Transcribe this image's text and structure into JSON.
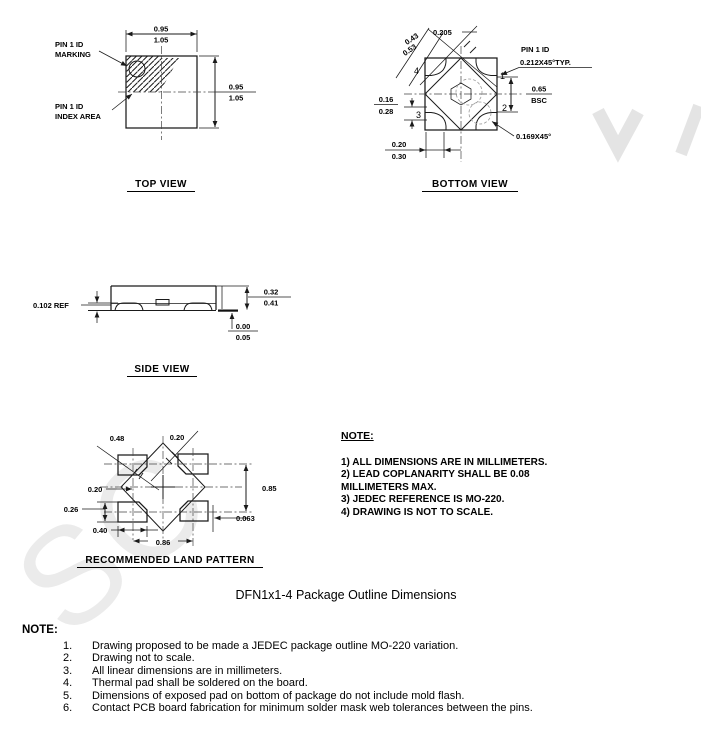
{
  "watermark": {
    "text": "SC"
  },
  "top_view": {
    "title": "TOP VIEW",
    "label_marking_1": "PIN 1 ID",
    "label_marking_2": "MARKING",
    "label_index_1": "PIN 1 ID",
    "label_index_2": "INDEX AREA",
    "dim_width_num": "0.95",
    "dim_width_den": "1.05",
    "dim_height_num": "0.95",
    "dim_height_den": "1.05"
  },
  "bottom_view": {
    "title": "BOTTOM VIEW",
    "dim_diag_num": "0.43",
    "dim_diag_den": "0.53",
    "dim_chamfer_small": "0.205",
    "label_pin1": "PIN 1 ID",
    "dim_pin1_chamfer": "0.212X45°TYP.",
    "dim_pitch_num": "0.65",
    "dim_pitch_den": "BSC",
    "dim_pad_h_num": "0.16",
    "dim_pad_h_den": "0.28",
    "dim_pad_w_num": "0.20",
    "dim_pad_w_den": "0.30",
    "dim_corner": "0.169X45°",
    "pin1": "1",
    "pin2": "2",
    "pin3": "3",
    "pin4": "4"
  },
  "side_view": {
    "title": "SIDE VIEW",
    "dim_ref": "0.102 REF",
    "dim_h_num": "0.32",
    "dim_h_den": "0.41",
    "dim_standoff_num": "0.00",
    "dim_standoff_den": "0.05"
  },
  "land_pattern": {
    "title": "RECOMMENDED LAND PATTERN",
    "dim_048": "0.48",
    "dim_020_top": "0.20",
    "dim_020_left": "0.20",
    "dim_026": "0.26",
    "dim_085": "0.85",
    "dim_0063": "0.063",
    "dim_040": "0.40",
    "dim_086": "0.86"
  },
  "drawing_note": {
    "heading": "NOTE:",
    "items": [
      "1) ALL DIMENSIONS ARE IN MILLIMETERS.",
      "2) LEAD COPLANARITY SHALL BE 0.08 MILLIMETERS MAX.",
      "3) JEDEC REFERENCE IS MO-220.",
      "4) DRAWING IS NOT TO SCALE."
    ]
  },
  "caption": "DFN1x1-4 Package Outline Dimensions",
  "footer_note": {
    "heading": "NOTE:",
    "items": [
      {
        "num": "1.",
        "text": "Drawing proposed to be made a JEDEC package outline MO-220 variation."
      },
      {
        "num": "2.",
        "text": "Drawing not to scale."
      },
      {
        "num": "3.",
        "text": "All linear dimensions are in millimeters."
      },
      {
        "num": "4.",
        "text": "Thermal pad shall be soldered on the board."
      },
      {
        "num": "5.",
        "text": "Dimensions of exposed pad on bottom of package do not include mold flash."
      },
      {
        "num": "6.",
        "text": "Contact PCB board fabrication for minimum solder mask web tolerances between the pins."
      }
    ]
  }
}
